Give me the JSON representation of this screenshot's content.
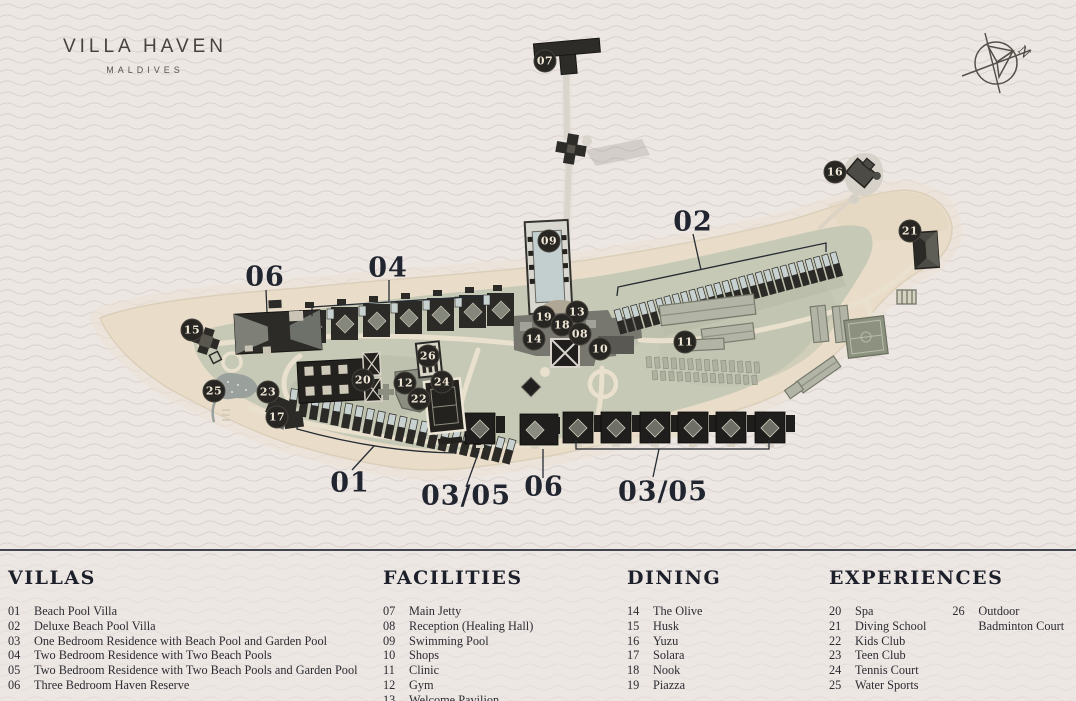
{
  "brand": {
    "title": "VILLA HAVEN",
    "subtitle": "MALDIVES"
  },
  "compass": {
    "label": "N"
  },
  "colors": {
    "background": "#ede7e4",
    "wave_line": "#d8cecb",
    "sand": "#e9ddca",
    "vegetation": "#c6c9b5",
    "building_dark": "#2b2a27",
    "building_gray": "#b2b5a5",
    "pool": "#c7d1d0",
    "badge_bg": "#282623",
    "badge_text": "#efe7d6",
    "label_text": "#21252f",
    "divider": "#41454c"
  },
  "map": {
    "badges": [
      {
        "n": "07",
        "x": 545,
        "y": 61
      },
      {
        "n": "09",
        "x": 549,
        "y": 241
      },
      {
        "n": "19",
        "x": 544,
        "y": 317
      },
      {
        "n": "13",
        "x": 577,
        "y": 312
      },
      {
        "n": "18",
        "x": 562,
        "y": 325
      },
      {
        "n": "14",
        "x": 534,
        "y": 339
      },
      {
        "n": "08",
        "x": 580,
        "y": 334
      },
      {
        "n": "10",
        "x": 600,
        "y": 349
      },
      {
        "n": "11",
        "x": 685,
        "y": 342
      },
      {
        "n": "16",
        "x": 835,
        "y": 172
      },
      {
        "n": "21",
        "x": 910,
        "y": 231
      },
      {
        "n": "15",
        "x": 192,
        "y": 330
      },
      {
        "n": "25",
        "x": 214,
        "y": 391
      },
      {
        "n": "23",
        "x": 268,
        "y": 392
      },
      {
        "n": "17",
        "x": 277,
        "y": 417
      },
      {
        "n": "20",
        "x": 363,
        "y": 380
      },
      {
        "n": "26",
        "x": 428,
        "y": 356
      },
      {
        "n": "12",
        "x": 405,
        "y": 383
      },
      {
        "n": "24",
        "x": 442,
        "y": 382
      },
      {
        "n": "22",
        "x": 419,
        "y": 399
      }
    ],
    "area_labels": [
      {
        "text": "02",
        "x": 693,
        "y": 222
      },
      {
        "text": "06",
        "x": 265,
        "y": 277
      },
      {
        "text": "04",
        "x": 388,
        "y": 268
      },
      {
        "text": "01",
        "x": 350,
        "y": 483
      },
      {
        "text": "03/05",
        "x": 466,
        "y": 496
      },
      {
        "text": "06",
        "x": 544,
        "y": 487
      },
      {
        "text": "03/05",
        "x": 663,
        "y": 492
      }
    ]
  },
  "legend": {
    "columns": [
      {
        "title": "VILLAS",
        "items": [
          {
            "num": "01",
            "label": "Beach Pool Villa"
          },
          {
            "num": "02",
            "label": "Deluxe Beach Pool Villa"
          },
          {
            "num": "03",
            "label": "One Bedroom Residence with Beach Pool and Garden Pool"
          },
          {
            "num": "04",
            "label": "Two Bedroom Residence with Two Beach Pools"
          },
          {
            "num": "05",
            "label": "Two Bedroom Residence with Two Beach Pools and Garden Pool"
          },
          {
            "num": "06",
            "label": "Three Bedroom Haven Reserve"
          }
        ]
      },
      {
        "title": "FACILITIES",
        "items": [
          {
            "num": "07",
            "label": "Main Jetty"
          },
          {
            "num": "08",
            "label": "Reception (Healing Hall)"
          },
          {
            "num": "09",
            "label": "Swimming Pool"
          },
          {
            "num": "10",
            "label": "Shops"
          },
          {
            "num": "11",
            "label": "Clinic"
          },
          {
            "num": "12",
            "label": "Gym"
          },
          {
            "num": "13",
            "label": "Welcome Pavilion"
          }
        ]
      },
      {
        "title": "DINING",
        "items": [
          {
            "num": "14",
            "label": "The Olive"
          },
          {
            "num": "15",
            "label": "Husk"
          },
          {
            "num": "16",
            "label": "Yuzu"
          },
          {
            "num": "17",
            "label": "Solara"
          },
          {
            "num": "18",
            "label": "Nook"
          },
          {
            "num": "19",
            "label": "Piazza"
          }
        ]
      },
      {
        "title": "EXPERIENCES",
        "items": [
          {
            "num": "20",
            "label": "Spa"
          },
          {
            "num": "21",
            "label": "Diving School"
          },
          {
            "num": "22",
            "label": "Kids Club"
          },
          {
            "num": "23",
            "label": "Teen Club"
          },
          {
            "num": "24",
            "label": "Tennis Court"
          },
          {
            "num": "25",
            "label": "Water Sports"
          }
        ],
        "items2": [
          {
            "num": "26",
            "label": "Outdoor Badminton Court"
          }
        ]
      }
    ]
  }
}
